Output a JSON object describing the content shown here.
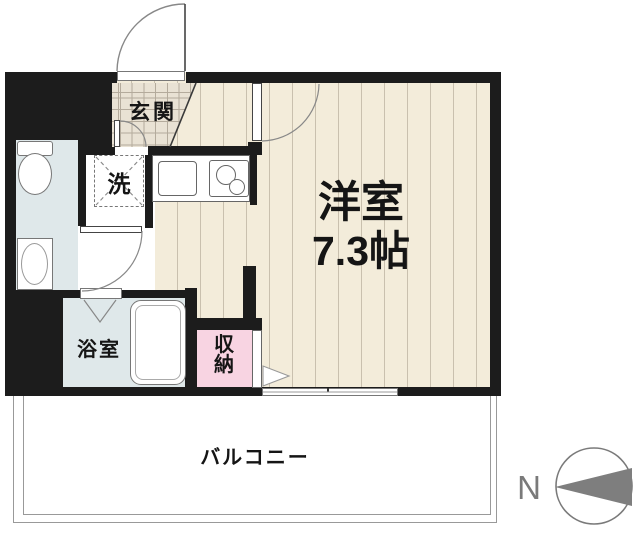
{
  "plan": {
    "rooms": {
      "entrance": {
        "label": "玄関"
      },
      "laundry": {
        "label": "洗"
      },
      "bathroom": {
        "label": "浴室"
      },
      "closet": {
        "label": "収納"
      },
      "western_room": {
        "label": "洋室",
        "size": "7.3帖"
      },
      "balcony": {
        "label": "バルコニー"
      }
    },
    "compass": {
      "north_label": "N"
    },
    "colors": {
      "wall": "#1c1c1c",
      "flooring": "#f3ecda",
      "flooring_stripe": "#c9c0ae",
      "entrance_tile": "#e9e2d4",
      "wet_area": "#dfe8ea",
      "closet_pink": "#f8d4e2",
      "outline_gray": "#888888",
      "compass_gray": "#7e7e7e"
    }
  }
}
